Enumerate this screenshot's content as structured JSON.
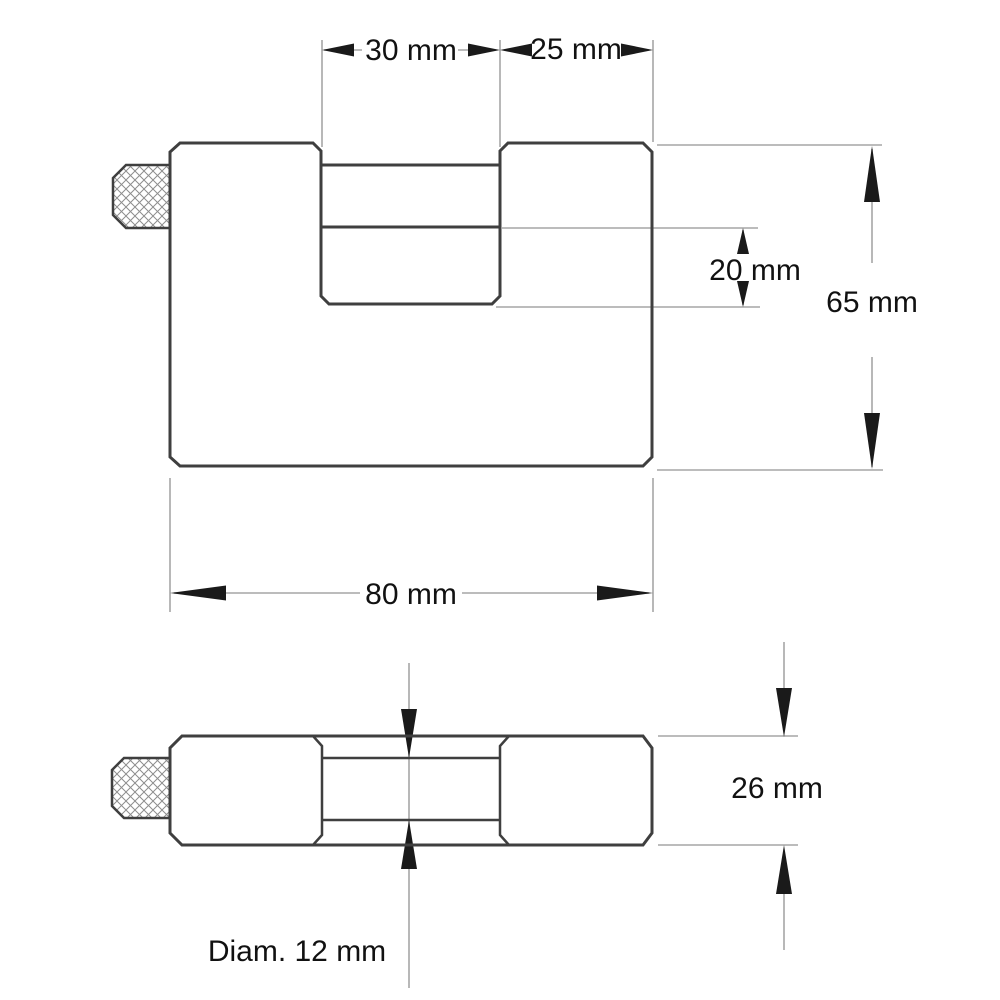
{
  "drawing": {
    "background": "#ffffff",
    "outline_color": "#3f3f3f",
    "dimension_line_color": "#a6a6a6",
    "arrow_color": "#1a1a1a",
    "text_color": "#111111"
  },
  "labels": {
    "slot_width": "30 mm",
    "right_block_width": "25 mm",
    "opening_height": "20 mm",
    "body_height": "65 mm",
    "body_width": "80 mm",
    "body_depth": "26 mm",
    "bolt_diameter": "Diam. 12 mm"
  },
  "dimension_values": {
    "slot_width_mm": 30,
    "right_block_width_mm": 25,
    "opening_height_mm": 20,
    "body_height_mm": 65,
    "body_width_mm": 80,
    "body_depth_mm": 26,
    "bolt_diameter_mm": 12
  }
}
